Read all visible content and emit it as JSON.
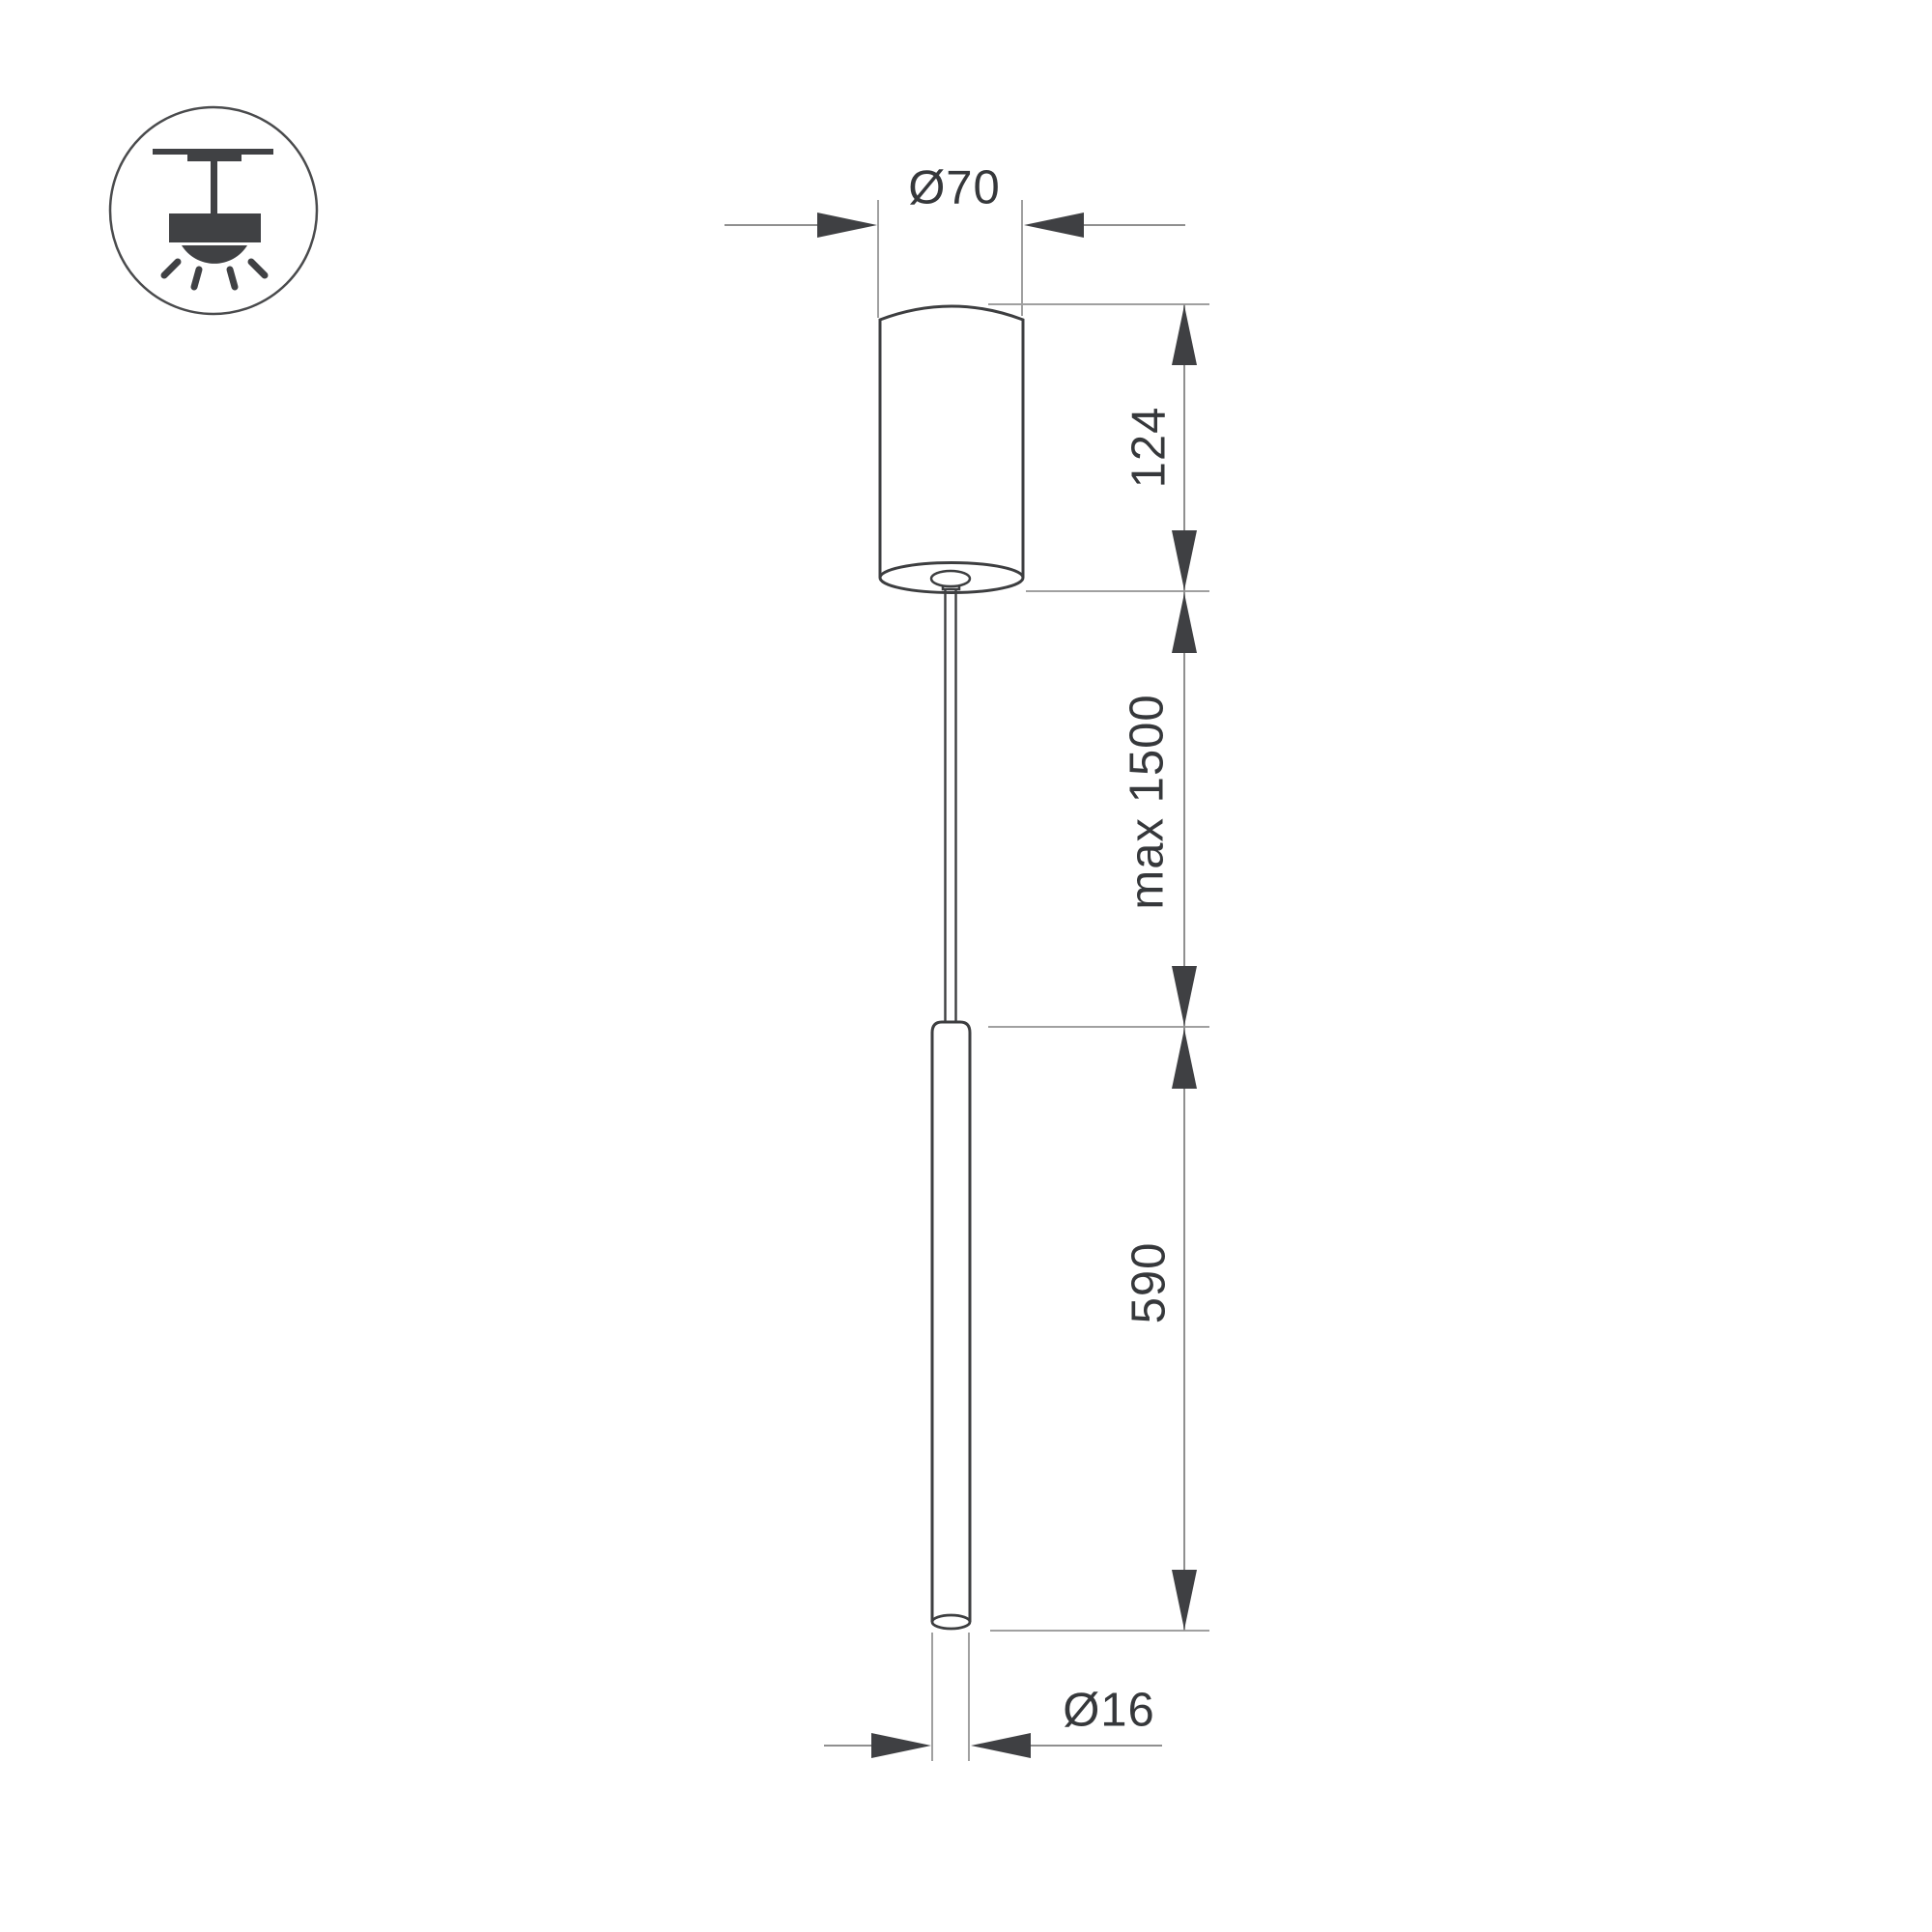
{
  "drawing": {
    "type": "pendant-luminaire-dimension-drawing",
    "dims": {
      "canopy_diameter": "Ø70",
      "canopy_height": "124",
      "suspension_max": "max 1500",
      "tube_length": "590",
      "tube_diameter": "Ø16"
    },
    "icon": {
      "name": "ceiling-pendant-light-icon"
    },
    "colors": {
      "background": "#ffffff",
      "outline": "#3d3e40",
      "icon_fill": "#404144",
      "dimension_line": "#8f8f8f",
      "extension_line": "#a0a0a0",
      "arrow": "#3f4043",
      "text": "#36383b"
    }
  }
}
